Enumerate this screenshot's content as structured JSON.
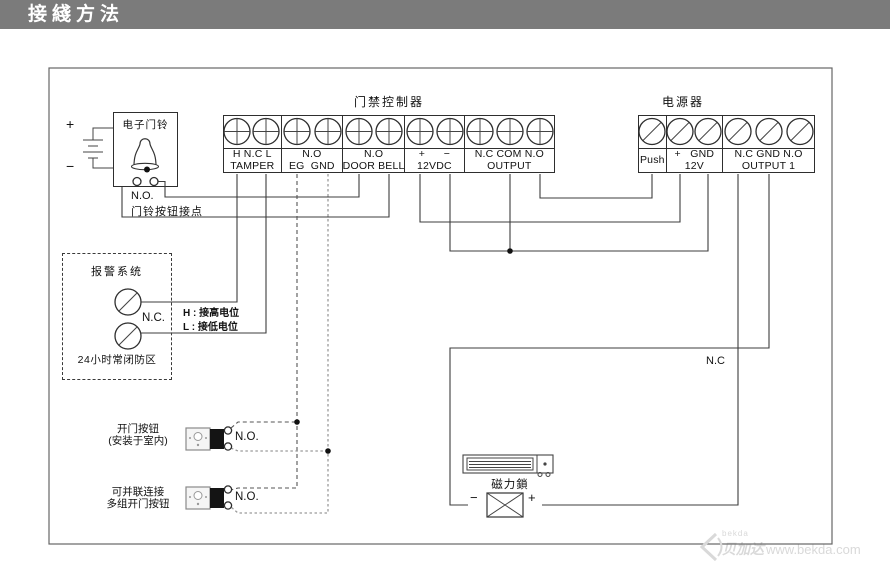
{
  "title_bar": {
    "title": "接綫方法"
  },
  "controller": {
    "title": "门禁控制器",
    "groups": [
      {
        "line1": "H N.C L",
        "line2": "TAMPER"
      },
      {
        "line1": "N.O",
        "line2": "EG  GND"
      },
      {
        "line1": "N.O",
        "line2": "DOOR BELL"
      },
      {
        "line1": "+      −",
        "line2": "12VDC"
      },
      {
        "line1": "N.C COM N.O",
        "line2": "OUTPUT"
      }
    ]
  },
  "power_supply": {
    "title": "电源器",
    "groups": [
      {
        "line1": "Push",
        "line2": ""
      },
      {
        "line1": "+   GND",
        "line2": "12V"
      },
      {
        "line1": "N.C GND N.O",
        "line2": "OUTPUT 1"
      }
    ]
  },
  "doorbell": {
    "title": "电子门铃",
    "battery_plus": "+",
    "battery_minus": "−",
    "no_label": "N.O.",
    "contact_label": "门铃按钮接点"
  },
  "alarm": {
    "title": "报警系统",
    "nc_label": "N.C.",
    "zone_label": "24小时常闭防区",
    "h_note": "H : 接高电位",
    "l_note": "L : 接低电位"
  },
  "buttons": {
    "button1": {
      "label_line1": "开门按钮",
      "label_line2": "(安装于室内)",
      "no_label": "N.O."
    },
    "button2": {
      "label_line1": "可并联连接",
      "label_line2": "多组开门按钮",
      "no_label": "N.O."
    }
  },
  "maglock": {
    "label": "磁力鎖",
    "minus": "−",
    "plus": "+"
  },
  "wires": {
    "nc_label": "N.C"
  },
  "watermark": {
    "logo_small": "bekda",
    "name": "贝加达",
    "url": "www.bekda.com"
  },
  "colors": {
    "title_bar_bg": "#7b7b7b",
    "line": "#3c3c3c",
    "frame": "#666666",
    "watermark": "#d9d9d9"
  }
}
